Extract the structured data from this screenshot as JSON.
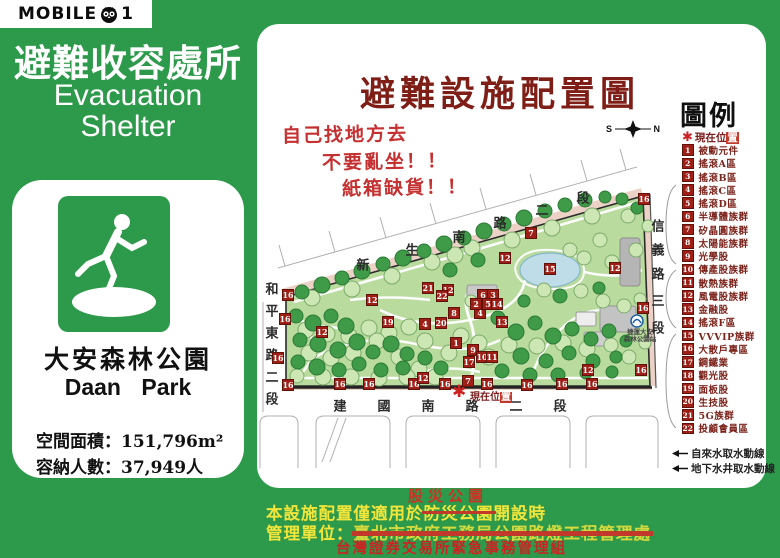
{
  "colors": {
    "brand_green": "#2d9a4b",
    "title_maroon": "#7e1e16",
    "graffiti_red": "#c53030",
    "marker_red": "#9e1f16",
    "footer_yellow": "#f3e53a",
    "footer_red": "#cc2222",
    "pond_blue": "#bfdde8"
  },
  "logo": {
    "left": "MOBILE",
    "right": "1",
    "owl": "owl-icon"
  },
  "sidebar": {
    "title_zh": "避難收容處所",
    "title_en_line1": "Evacuation",
    "title_en_line2": "Shelter",
    "park_name_zh": "大安森林公園",
    "park_name_en": "Daan Park",
    "stats": [
      "空間面積：151,796m²",
      "容納人數：37,949人"
    ]
  },
  "main": {
    "title": "避難設施配置圖",
    "graffiti": [
      "自己找地方去",
      "不要亂坐！！",
      "紙箱缺貨！！"
    ],
    "compass": {
      "s": "S",
      "n": "N"
    }
  },
  "map": {
    "streets": {
      "top": "新生南路二段",
      "left": "和平東路二段",
      "bottom": "建國南路二段",
      "right": "信義路三段"
    },
    "star_label_pre": "現在位",
    "star_label_boxed": "置",
    "star_glyph": "✱",
    "mrt_line1": "捷運大安",
    "mrt_line2": "森林公園站",
    "markers": [
      {
        "n": "16",
        "x": 288,
        "y": 295
      },
      {
        "n": "16",
        "x": 285,
        "y": 319
      },
      {
        "n": "16",
        "x": 278,
        "y": 358
      },
      {
        "n": "16",
        "x": 288,
        "y": 385
      },
      {
        "n": "16",
        "x": 340,
        "y": 384
      },
      {
        "n": "16",
        "x": 369,
        "y": 384
      },
      {
        "n": "16",
        "x": 414,
        "y": 384
      },
      {
        "n": "16",
        "x": 445,
        "y": 384
      },
      {
        "n": "16",
        "x": 487,
        "y": 384
      },
      {
        "n": "16",
        "x": 527,
        "y": 385
      },
      {
        "n": "16",
        "x": 562,
        "y": 384
      },
      {
        "n": "16",
        "x": 592,
        "y": 384
      },
      {
        "n": "16",
        "x": 641,
        "y": 370
      },
      {
        "n": "16",
        "x": 643,
        "y": 308
      },
      {
        "n": "16",
        "x": 644,
        "y": 199
      },
      {
        "n": "12",
        "x": 372,
        "y": 300
      },
      {
        "n": "12",
        "x": 322,
        "y": 332
      },
      {
        "n": "12",
        "x": 448,
        "y": 290
      },
      {
        "n": "12",
        "x": 505,
        "y": 258
      },
      {
        "n": "12",
        "x": 615,
        "y": 268
      },
      {
        "n": "12",
        "x": 588,
        "y": 370
      },
      {
        "n": "12",
        "x": 423,
        "y": 378
      },
      {
        "n": "19",
        "x": 388,
        "y": 322
      },
      {
        "n": "21",
        "x": 428,
        "y": 288
      },
      {
        "n": "22",
        "x": 442,
        "y": 296
      },
      {
        "n": "8",
        "x": 454,
        "y": 313
      },
      {
        "n": "20",
        "x": 441,
        "y": 323
      },
      {
        "n": "4",
        "x": 425,
        "y": 324
      },
      {
        "n": "4",
        "x": 480,
        "y": 313
      },
      {
        "n": "1",
        "x": 456,
        "y": 343
      },
      {
        "n": "9",
        "x": 473,
        "y": 350
      },
      {
        "n": "10",
        "x": 482,
        "y": 357
      },
      {
        "n": "11",
        "x": 492,
        "y": 357
      },
      {
        "n": "17",
        "x": 469,
        "y": 362
      },
      {
        "n": "6",
        "x": 483,
        "y": 295
      },
      {
        "n": "3",
        "x": 493,
        "y": 295
      },
      {
        "n": "2",
        "x": 476,
        "y": 304
      },
      {
        "n": "5",
        "x": 488,
        "y": 304
      },
      {
        "n": "14",
        "x": 497,
        "y": 304
      },
      {
        "n": "13",
        "x": 502,
        "y": 322
      },
      {
        "n": "7",
        "x": 531,
        "y": 233
      },
      {
        "n": "7",
        "x": 468,
        "y": 381
      },
      {
        "n": "15",
        "x": 550,
        "y": 269
      }
    ]
  },
  "legend": {
    "title": "圖例",
    "current_pre": "現在位",
    "current_boxed": "置",
    "star_glyph": "✱",
    "items": [
      {
        "num": "1",
        "label": "被動元件"
      },
      {
        "num": "2",
        "label": "搖滾A區"
      },
      {
        "num": "3",
        "label": "搖滾B區"
      },
      {
        "num": "4",
        "label": "搖滾C區"
      },
      {
        "num": "5",
        "label": "搖滾D區"
      },
      {
        "num": "6",
        "label": "半導體族群"
      },
      {
        "num": "7",
        "label": "矽晶圓族群"
      },
      {
        "num": "8",
        "label": "太陽能族群"
      },
      {
        "num": "9",
        "label": "光學股"
      },
      {
        "num": "10",
        "label": "傳產股族群"
      },
      {
        "num": "11",
        "label": "散熱族群"
      },
      {
        "num": "12",
        "label": "風電股族群"
      },
      {
        "num": "13",
        "label": "金融股"
      },
      {
        "num": "14",
        "label": "搖滾F區"
      },
      {
        "num": "15",
        "label": "VVVIP族群"
      },
      {
        "num": "16",
        "label": "大散戶專區"
      },
      {
        "num": "17",
        "label": "鋼鐵業"
      },
      {
        "num": "18",
        "label": "觀光股"
      },
      {
        "num": "19",
        "label": "面板股"
      },
      {
        "num": "20",
        "label": "生技股"
      },
      {
        "num": "21",
        "label": "5G族群"
      },
      {
        "num": "22",
        "label": "投顧會員區"
      }
    ],
    "water": [
      {
        "label": "自來水取水動線"
      },
      {
        "label": "地下水井取水動線"
      }
    ]
  },
  "footer": {
    "overlay_red": "股災公園",
    "line1_prefix": "本設施配置僅適用於",
    "line1_struck": "防災公園",
    "line1_suffix": "開設時",
    "line2_label": "管理單位：",
    "line2_struck": "臺北市政府工務局公園路燈工程管理處",
    "line3_red": "台灣證券交易所緊急事務管理組"
  }
}
